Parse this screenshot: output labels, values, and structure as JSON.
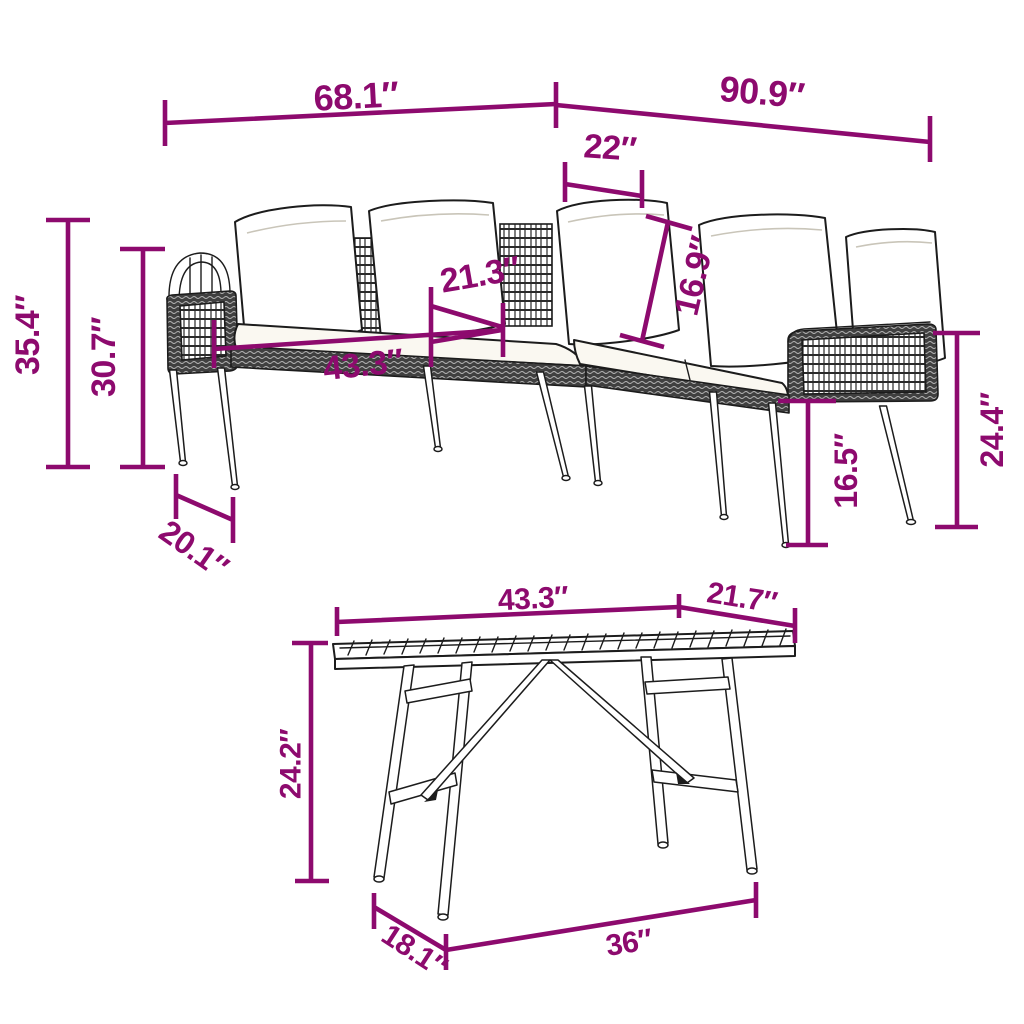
{
  "page": {
    "background": "#ffffff",
    "description": "Dimension diagram of an L-shaped poly-rattan corner sofa with cushions and a slatted-top garden table"
  },
  "colors": {
    "dimension_annotation": "#8d0a6e",
    "line_art": "#1c1c1c",
    "wicker_dark": "#404040",
    "cushion_white": "#faf8f1"
  },
  "sofa": {
    "dims": {
      "left_length": "68.1″",
      "right_length": "90.9″",
      "back_cushion_width": "22″",
      "total_height": "35.4″",
      "seat_back_height": "30.7″",
      "side_depth": "20.1″",
      "seat_depth": "21.3″",
      "seat_length": "43.3″",
      "back_cushion_height": "16.9″",
      "seat_height": "16.5″",
      "arm_height": "24.4″"
    }
  },
  "table": {
    "dims": {
      "top_length": "43.3″",
      "top_depth": "21.7″",
      "height": "24.2″",
      "base_depth": "18.1″",
      "base_length": "36″"
    }
  }
}
